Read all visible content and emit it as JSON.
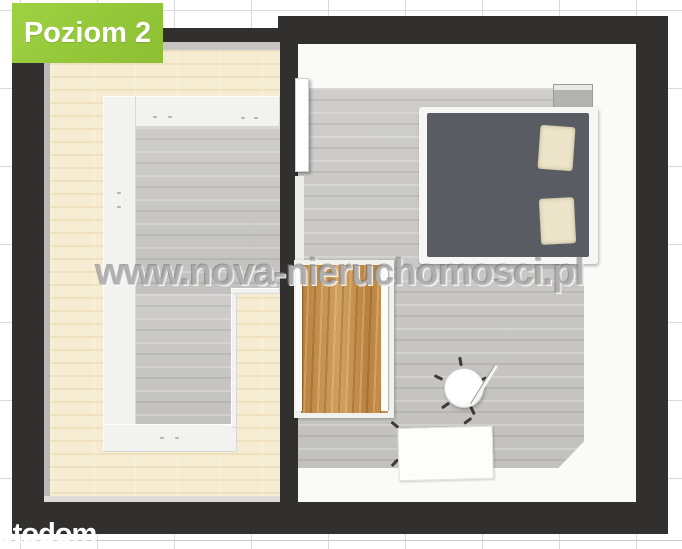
{
  "overlay": {
    "level_badge": {
      "label": "Poziom 2",
      "bg_color": "#95C93D",
      "text_color": "#FFFFFF"
    },
    "watermark": {
      "text": "www.nova-nieruchomosci.pl"
    },
    "portal_logo": {
      "text": "otodom",
      "color": "#FFFFFF"
    }
  },
  "floorplan": {
    "type": "3d-top-down-floor-plan",
    "level": "Poziom 2",
    "wall_color": "#31302E",
    "background_grid": {
      "line_color": "#DADADA",
      "cell_px": 77
    },
    "rooms": [
      {
        "id": "left-room",
        "floor": {
          "style": "light-wood",
          "color": "#F6ECD2"
        },
        "features": [
          {
            "name": "stair-void",
            "shape": "L",
            "floor_color": "#C9C8C6"
          },
          {
            "name": "white-railing",
            "color": "#F2F2F0"
          }
        ]
      },
      {
        "id": "right-room",
        "floor": {
          "style": "gray-planks",
          "color": "#C9C8C6"
        },
        "furniture": [
          {
            "name": "double-bed",
            "frame_color": "#F6F6F4",
            "mattress_color": "#595C63",
            "pillow_color": "#ECE5C9",
            "pillow_count": 2
          },
          {
            "name": "wardrobe",
            "wood_color": "#C28C4F"
          },
          {
            "name": "round-chair",
            "color": "#FFFFFF"
          },
          {
            "name": "floor-lamp"
          },
          {
            "name": "desk",
            "color": "#FDFDFB"
          },
          {
            "name": "door",
            "state": "open"
          },
          {
            "name": "wall-ledge",
            "color": "#B3B3B1"
          }
        ]
      }
    ]
  }
}
